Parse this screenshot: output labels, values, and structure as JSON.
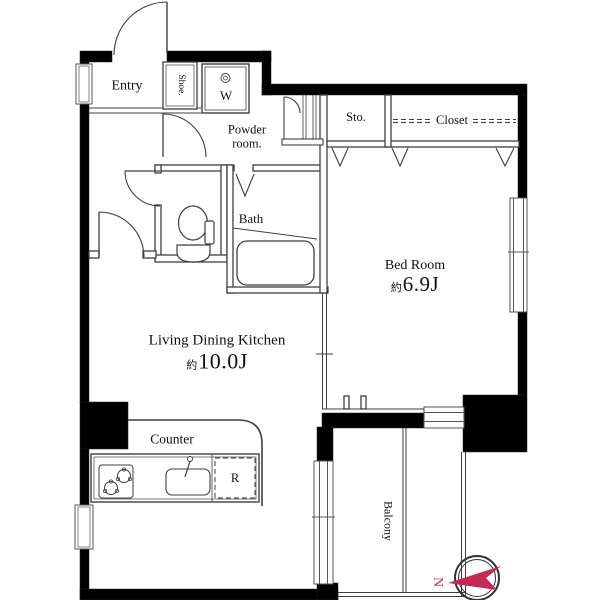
{
  "plan": {
    "entry_label": "Entry",
    "shoe_label": "Shoe.",
    "washer_label": "W",
    "powder_line1": "Powder",
    "powder_line2": "room.",
    "bath_label": "Bath",
    "storage_label": "Sto.",
    "closet_label": "Closet",
    "bedroom_label": "Bed Room",
    "bedroom_size_prefix": "約",
    "bedroom_size": "6.9J",
    "ldk_label": "Living Dining Kitchen",
    "ldk_size_prefix": "約",
    "ldk_size": "10.0J",
    "counter_label": "Counter",
    "fridge_label": "R",
    "balcony_label": "Balcony"
  },
  "compass": {
    "north_label": "N",
    "color": "#C62A52"
  },
  "colors": {
    "wall": "#000000",
    "line": "#3f3f3f",
    "text": "#111111"
  },
  "icons": {
    "fixtures": [
      "toilet-icon",
      "bathtub-icon",
      "kitchen-sink-icon",
      "stove-icon",
      "washing-machine-icon",
      "compass-icon",
      "bifold-door-icon"
    ]
  }
}
